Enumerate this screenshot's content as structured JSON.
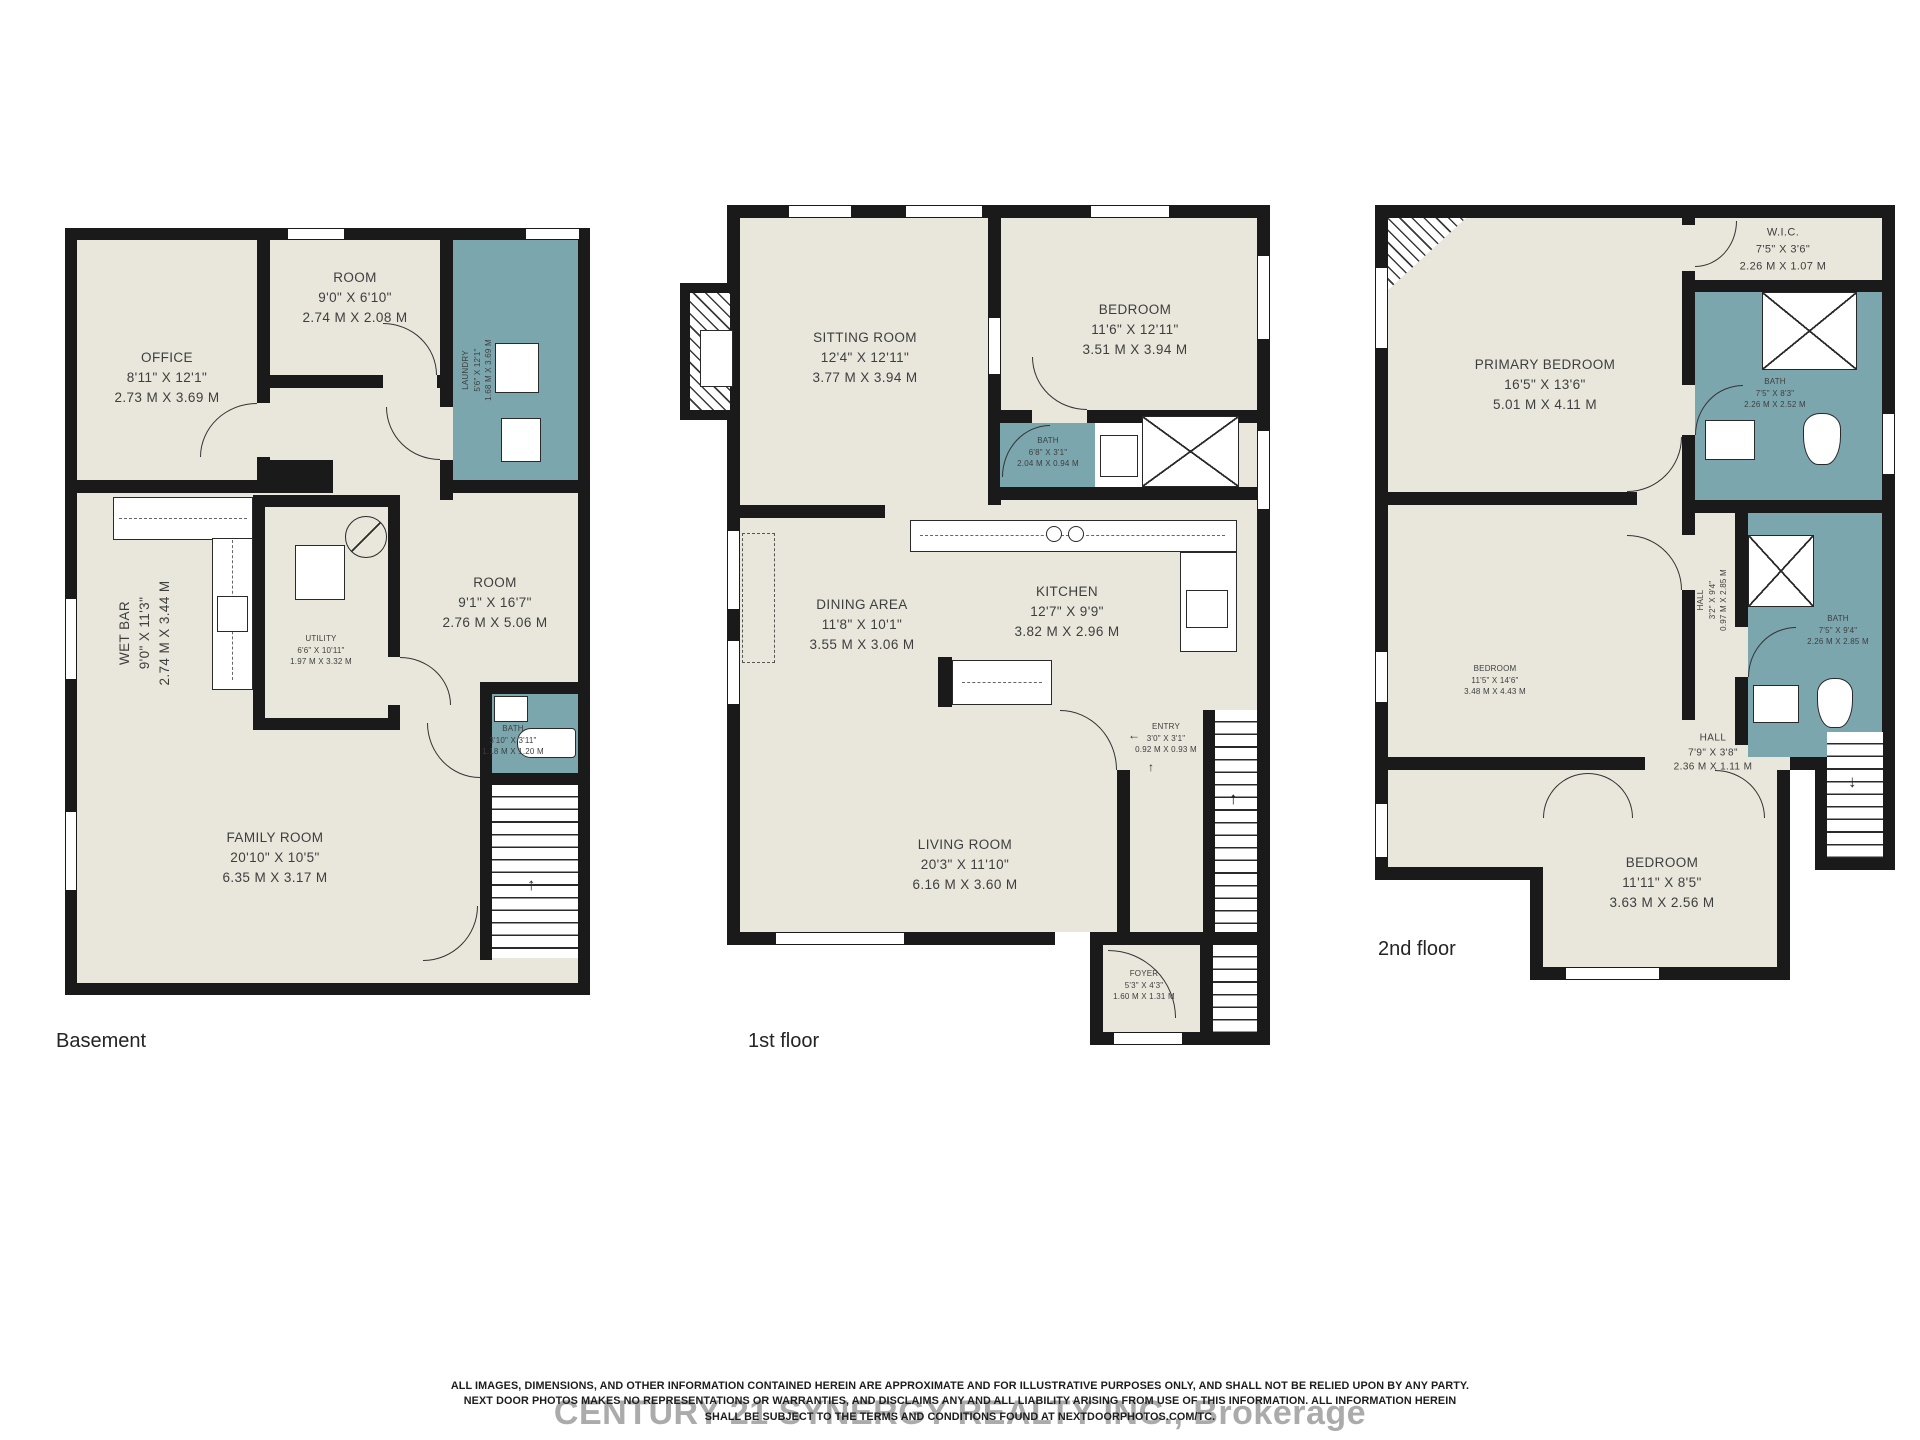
{
  "colors": {
    "floor_fill": "#e9e6dc",
    "wet_area_fill": "#7ca6ae",
    "wall": "#1a1a1a"
  },
  "floors": {
    "basement": {
      "caption": "Basement",
      "office": {
        "name": "OFFICE",
        "imp": "8'11\" X 12'1\"",
        "met": "2.73 M X 3.69 M"
      },
      "room_top": {
        "name": "ROOM",
        "imp": "9'0\" X 6'10\"",
        "met": "2.74 M X 2.08 M"
      },
      "laundry": {
        "name": "LAUNDRY",
        "imp": "5'6\" X 12'1\"",
        "met": "1.68 M X 3.69 M"
      },
      "wet_bar": {
        "name": "WET BAR",
        "imp": "9'0\" X 11'3\"",
        "met": "2.74 M X 3.44 M"
      },
      "utility": {
        "name": "UTILITY",
        "imp": "6'6\" X 10'11\"",
        "met": "1.97 M X 3.32 M"
      },
      "room_mid": {
        "name": "ROOM",
        "imp": "9'1\" X 16'7\"",
        "met": "2.76 M X 5.06 M"
      },
      "bath": {
        "name": "BATH",
        "imp": "3'10\" X 3'11\"",
        "met": "1.18 M X 1.20 M"
      },
      "family_room": {
        "name": "FAMILY ROOM",
        "imp": "20'10\" X 10'5\"",
        "met": "6.35 M X 3.17 M"
      }
    },
    "first": {
      "caption": "1st floor",
      "sitting": {
        "name": "SITTING ROOM",
        "imp": "12'4\" X 12'11\"",
        "met": "3.77 M X 3.94 M"
      },
      "bedroom": {
        "name": "BEDROOM",
        "imp": "11'6\" X 12'11\"",
        "met": "3.51 M X 3.94 M"
      },
      "bath": {
        "name": "BATH",
        "imp": "6'8\" X 3'1\"",
        "met": "2.04 M X 0.94 M"
      },
      "dining": {
        "name": "DINING AREA",
        "imp": "11'8\" X 10'1\"",
        "met": "3.55 M X 3.06 M"
      },
      "kitchen": {
        "name": "KITCHEN",
        "imp": "12'7\" X 9'9\"",
        "met": "3.82 M X 2.96 M"
      },
      "entry": {
        "name": "ENTRY",
        "imp": "3'0\" X 3'1\"",
        "met": "0.92 M X 0.93 M"
      },
      "living": {
        "name": "LIVING ROOM",
        "imp": "20'3\" X 11'10\"",
        "met": "6.16 M X 3.60 M"
      },
      "foyer": {
        "name": "FOYER",
        "imp": "5'3\" X 4'3\"",
        "met": "1.60 M X 1.31 M"
      }
    },
    "second": {
      "caption": "2nd floor",
      "wic": {
        "name": "W.I.C.",
        "imp": "7'5\" X 3'6\"",
        "met": "2.26 M X 1.07 M"
      },
      "primary": {
        "name": "PRIMARY BEDROOM",
        "imp": "16'5\" X 13'6\"",
        "met": "5.01 M X 4.11 M"
      },
      "bath_top": {
        "name": "BATH",
        "imp": "7'5\" X 8'3\"",
        "met": "2.26 M X 2.52 M"
      },
      "hall_upper": {
        "name": "HALL",
        "imp": "3'2\" X 9'4\"",
        "met": "0.97 M X 2.85 M"
      },
      "bath_mid": {
        "name": "BATH",
        "imp": "7'5\" X 9'4\"",
        "met": "2.26 M X 2.85 M"
      },
      "bedroom_mid": {
        "name": "BEDROOM",
        "imp": "11'5\" X 14'6\"",
        "met": "3.48 M X 4.43 M"
      },
      "hall_lower": {
        "name": "HALL",
        "imp": "7'9\" X 3'8\"",
        "met": "2.36 M X 1.11 M"
      },
      "bedroom_lower": {
        "name": "BEDROOM",
        "imp": "11'11\" X 8'5\"",
        "met": "3.63 M X 2.56 M"
      }
    }
  },
  "icons": {
    "stairs_up": "↑",
    "stairs_down": "↓",
    "entry_left": "←",
    "entry_up": "↑"
  },
  "footer": {
    "brokerage": "CENTURY 21 SYNERGY REALTY INC., Brokerage",
    "disclaimer_line1": "ALL IMAGES, DIMENSIONS, AND OTHER INFORMATION CONTAINED HEREIN ARE APPROXIMATE AND FOR ILLUSTRATIVE PURPOSES ONLY, AND SHALL NOT BE RELIED UPON BY ANY PARTY.",
    "disclaimer_line2": "NEXT DOOR PHOTOS MAKES NO REPRESENTATIONS OR WARRANTIES, AND DISCLAIMS ANY AND ALL LIABILITY ARISING FROM USE OF THIS INFORMATION. ALL INFORMATION HEREIN",
    "disclaimer_line3": "SHALL BE SUBJECT TO THE TERMS AND CONDITIONS FOUND AT NEXTDOORPHOTOS.COM/TC."
  }
}
